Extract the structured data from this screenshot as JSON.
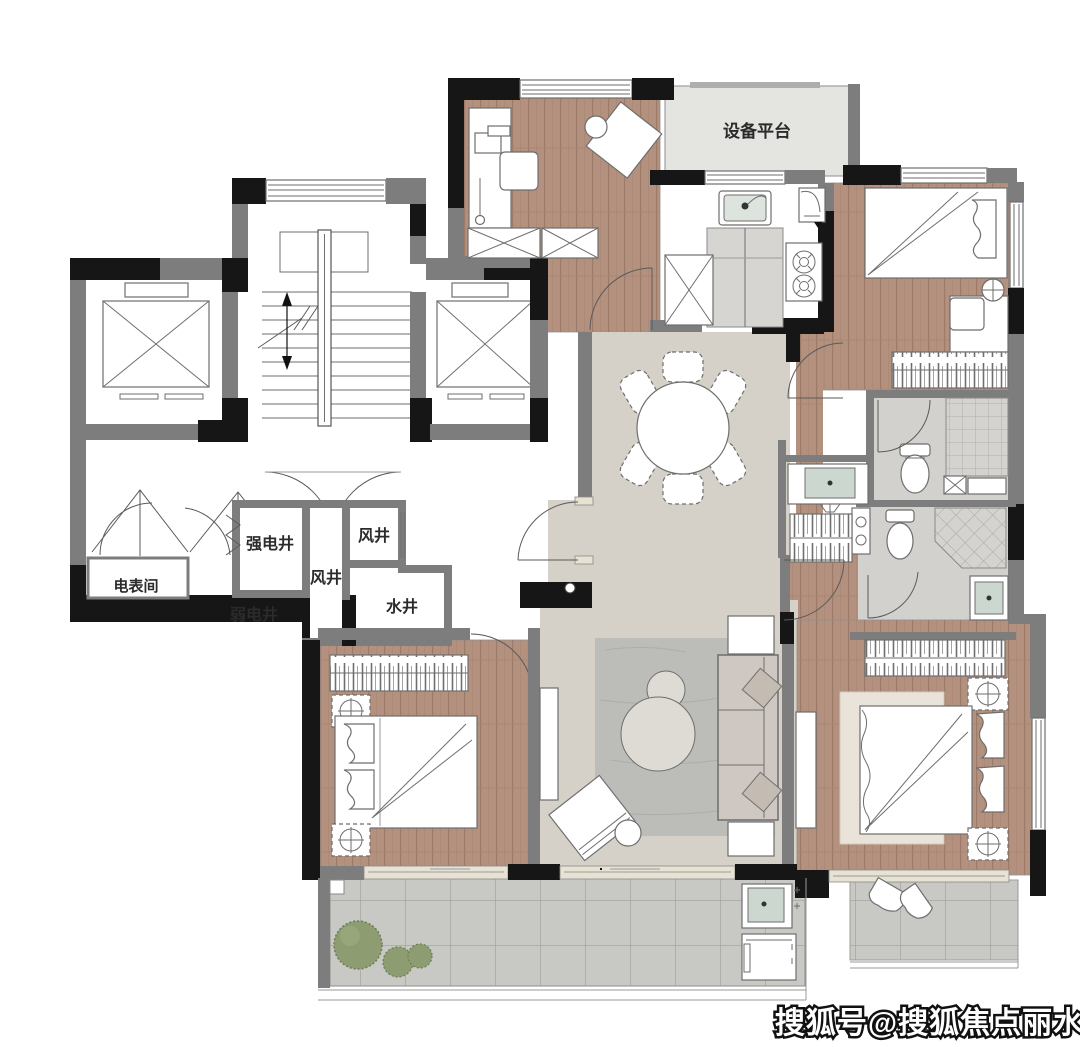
{
  "labels": {
    "equipment_platform": "设备平台",
    "strong_electric_shaft": "强电井",
    "weak_electric_shaft": "弱电井",
    "wind_shaft_upper": "风井",
    "wind_shaft_center": "风井",
    "water_shaft": "水井",
    "meter_room": "电表间"
  },
  "watermark": "搜狐号@搜狐焦点丽水站",
  "colors": {
    "wall_black": "#161616",
    "wall_gray": "#7d7d7d",
    "wood_floor": "#b3917e",
    "dining_tile": "#d5d0c8",
    "balcony_tile": "#c8c8c5",
    "bath_floor": "#d2d1cd",
    "platform_fill": "#e4e5e1",
    "rug_gray": "#bcbcb9",
    "rug_beige": "#e9e3d9",
    "basin_green": "#ccd8cf",
    "plant_green": "#8d9d71"
  }
}
